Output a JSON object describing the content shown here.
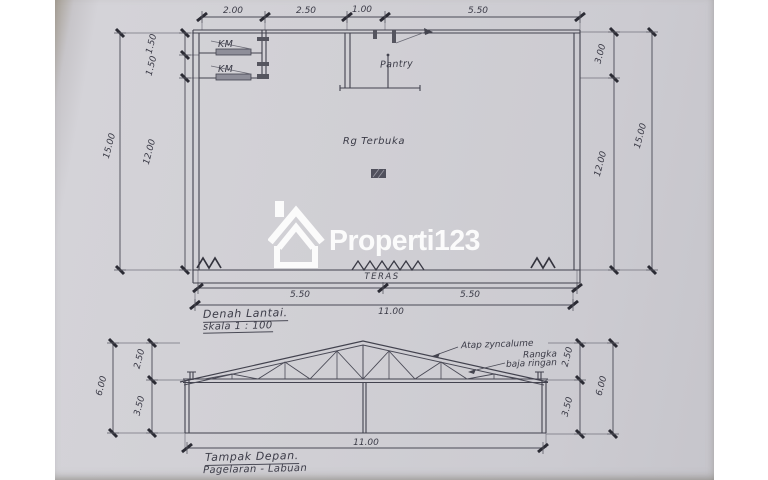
{
  "watermark": {
    "brand": "Properti123",
    "color": "#ffffff"
  },
  "colors": {
    "paper": "#d0cfd4",
    "ink": "#42424e",
    "tick": "#2b2b34"
  },
  "floor_plan": {
    "title": "Denah Lantai.",
    "scale": "skala 1 : 100",
    "rooms": {
      "km1": "KM",
      "km2": "KM",
      "pantry": "Pantry",
      "open_space": "Rg Terbuka",
      "terrace": "TERAS"
    },
    "dims_top": [
      "2.00",
      "2.50",
      "1.00",
      "5.50"
    ],
    "dims_left": [
      "1.50",
      "1.50",
      "12.00",
      "15.00"
    ],
    "dims_right": [
      "3.00",
      "12.00",
      "15.00"
    ],
    "dims_bottom": [
      "5.50",
      "5.50",
      "11.00"
    ]
  },
  "elevation": {
    "title": "Tampak Depan.",
    "subtitle": "Pagelaran - Labuan",
    "annotation": [
      "Atap zyncalume",
      "Rangka",
      "baja ringan"
    ],
    "dims_left": [
      "2.50",
      "3.50",
      "6.00"
    ],
    "dims_right": [
      "2.50",
      "3.50",
      "6.00"
    ],
    "dim_bottom": "11.00"
  }
}
